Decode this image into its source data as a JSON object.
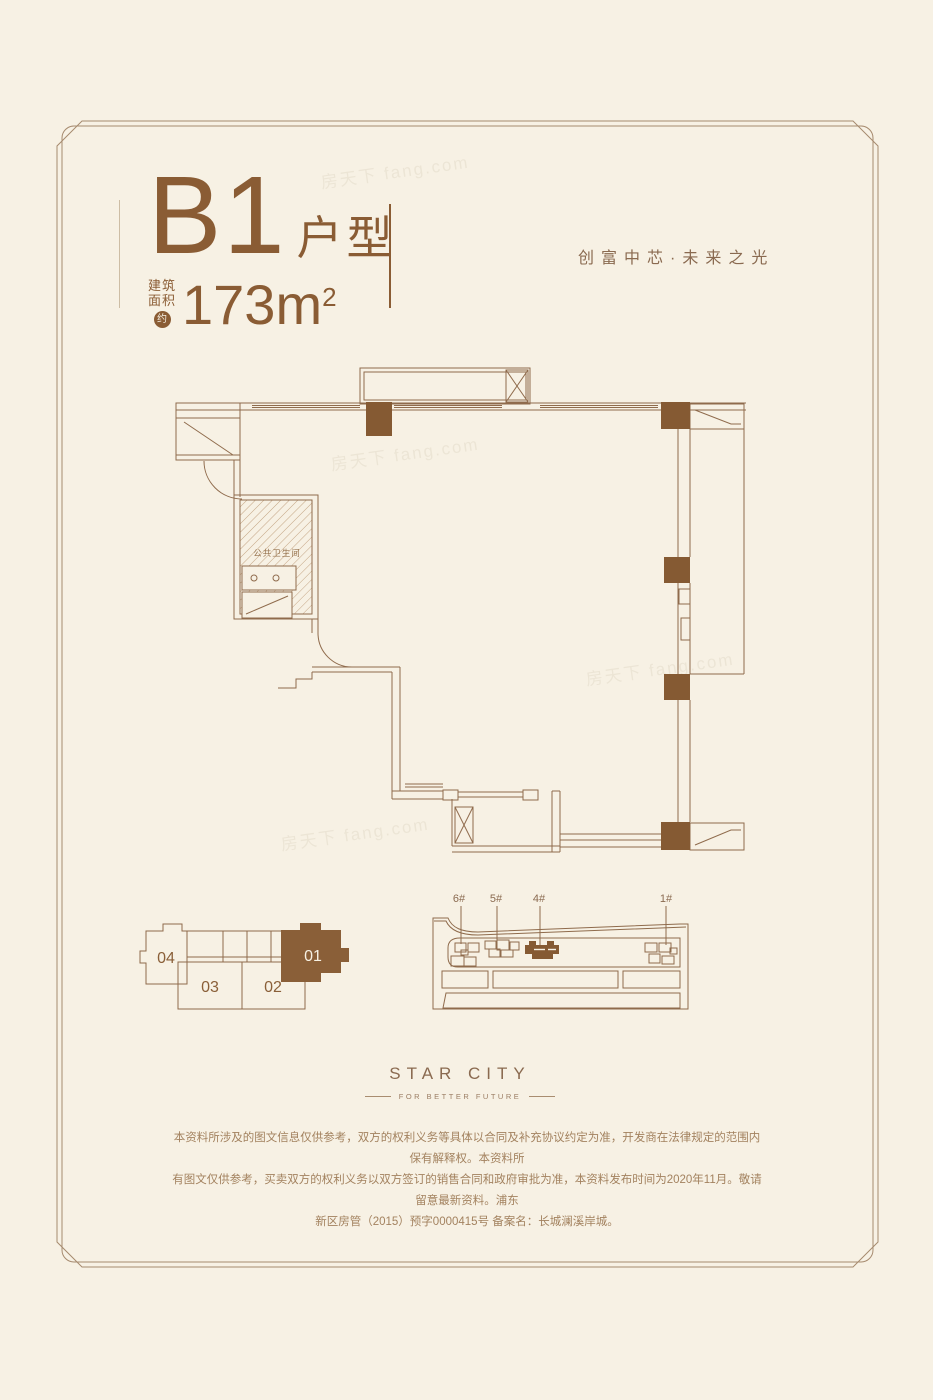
{
  "page": {
    "background": "#f7f1e4",
    "accent_brown": "#8a5c34",
    "line_brown": "#8f6b4c",
    "muted_brown": "#a3825f",
    "column_fill": "#855a33"
  },
  "header": {
    "unit_code": "B1",
    "unit_suffix": "户型",
    "area_label_line1": "建筑",
    "area_label_line2": "面积",
    "area_approx_badge": "约",
    "area_value": "173m",
    "area_superscript": "2",
    "tagline": "创富中芯·未来之光"
  },
  "floor_plan": {
    "bathroom_label": "公共卫生间"
  },
  "unit_key_plan": {
    "unit_04": "04",
    "unit_03": "03",
    "unit_02": "02",
    "unit_01": "01",
    "highlighted_unit": "01"
  },
  "site_plan": {
    "building_6": "6#",
    "building_5": "5#",
    "building_4": "4#",
    "building_1": "1#",
    "highlighted_building": "4#"
  },
  "brand": {
    "name": "STAR CITY",
    "slogan": "FOR BETTER FUTURE"
  },
  "disclaimer": {
    "line1": "本资料所涉及的图文信息仅供参考，双方的权利义务等具体以合同及补充协议约定为准，开发商在法律规定的范围内保有解释权。本资料所",
    "line2": "有图文仅供参考，买卖双方的权利义务以双方签订的销售合同和政府审批为准，本资料发布时间为2020年11月。敬请留意最新资料。浦东",
    "line3": "新区房管（2015）预字0000415号  备案名：长城澜溪岸城。"
  },
  "watermark": "房天下 fang.com"
}
